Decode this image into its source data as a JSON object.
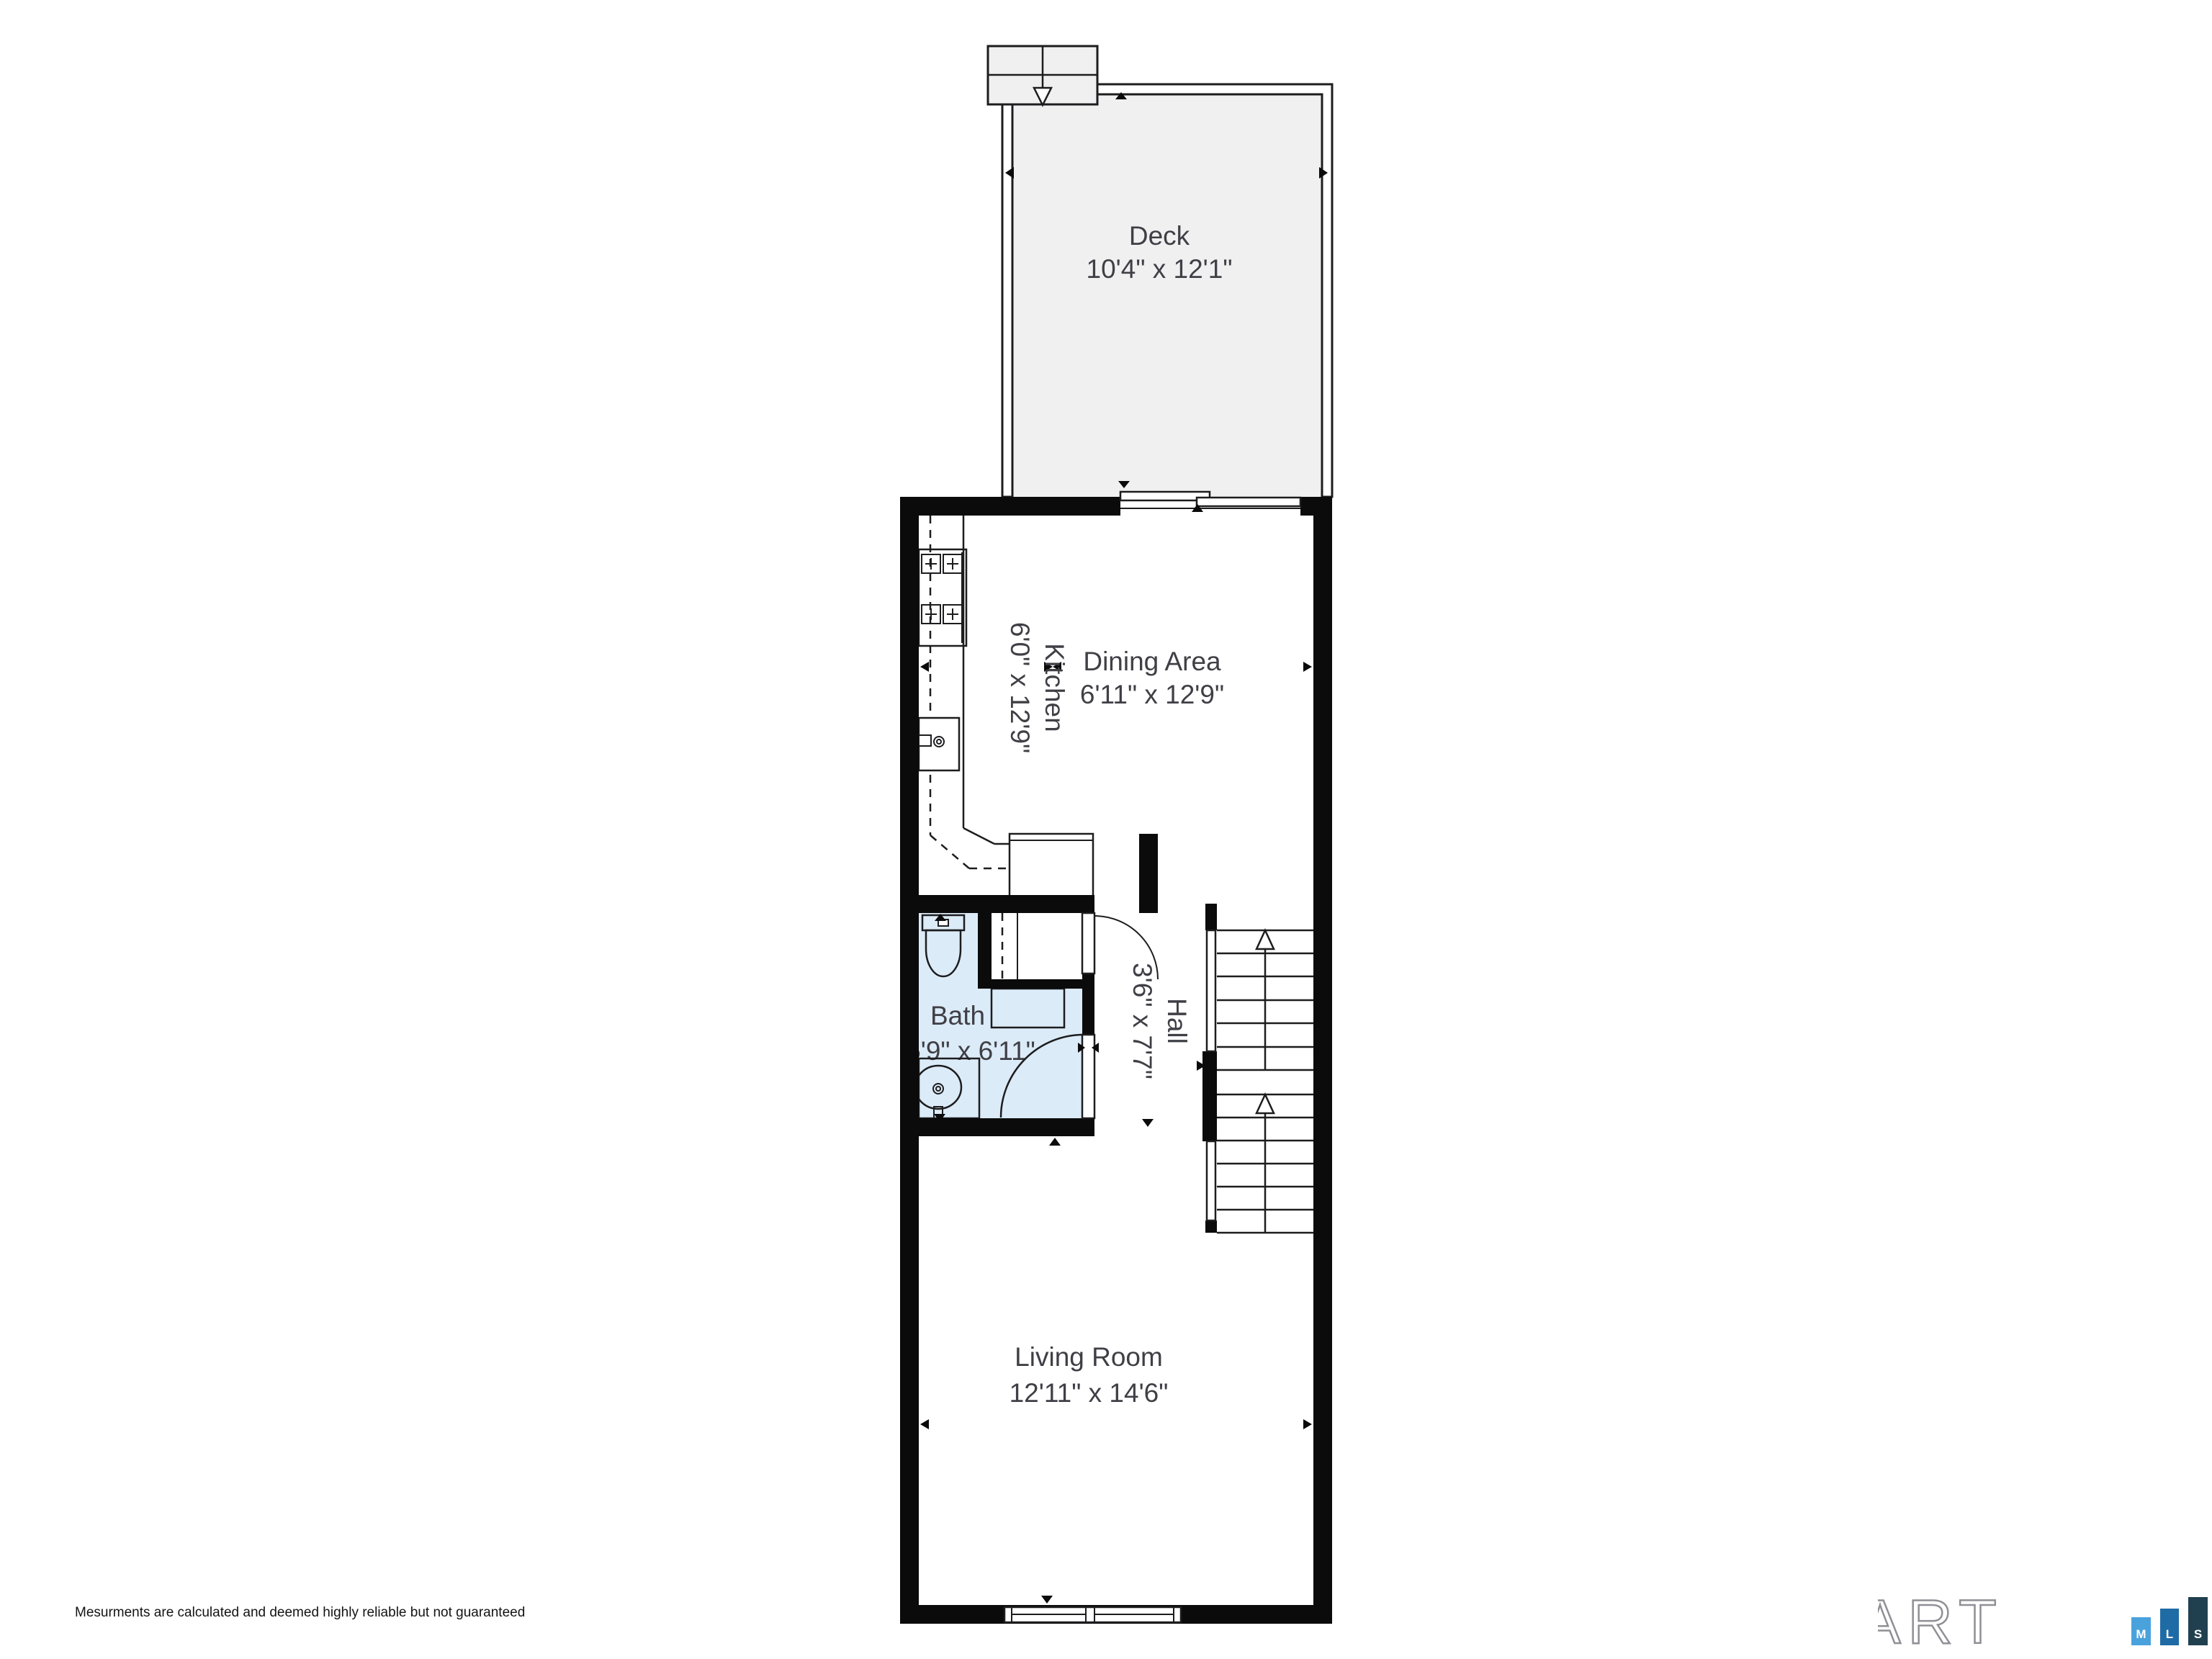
{
  "plan": {
    "rooms": {
      "deck": {
        "label": "Deck",
        "dims": "10'4\" x 12'1\""
      },
      "kitchen": {
        "label": "Kitchen",
        "dims": "6'0\" x 12'9\""
      },
      "dining": {
        "label": "Dining Area",
        "dims": "6'11\" x 12'9\""
      },
      "bath": {
        "label": "Bath",
        "dims": "5'9\" x 6'11\""
      },
      "hall": {
        "label": "Hall",
        "dims": "3'6\" x 7'7\""
      },
      "living": {
        "label": "Living Room",
        "dims": "12'11\" x 14'6\""
      }
    },
    "colors": {
      "wall": "#0b0b0c",
      "line": "#1d1d1f",
      "bath_fill": "#dcebf8",
      "deck_fill": "#f0f0f1",
      "label": "#3f3f46"
    }
  },
  "footer": {
    "disclaimer": "Mesurments are calculated and deemed highly reliable but not guaranteed"
  },
  "logo": {
    "word": "SMART",
    "tiles": [
      {
        "letter": "M",
        "color": "#4aa2dd"
      },
      {
        "letter": "L",
        "color": "#1f6ba6"
      },
      {
        "letter": "S",
        "color": "#20404f"
      }
    ]
  }
}
